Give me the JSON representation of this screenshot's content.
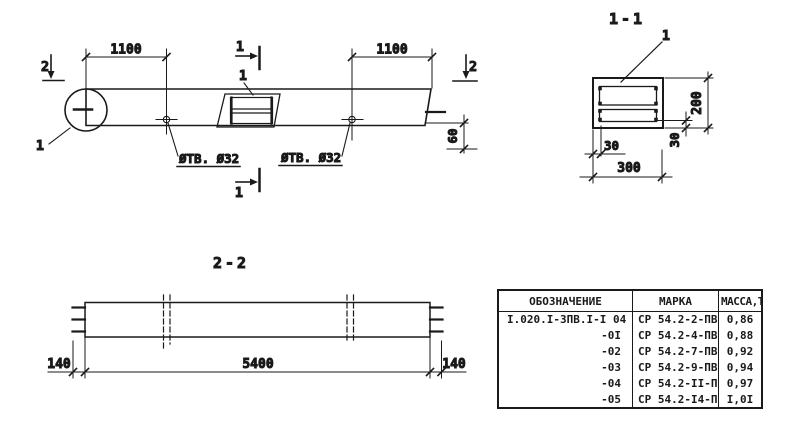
{
  "colors": {
    "ink": "#1a1a1a",
    "paper": "#ffffff"
  },
  "drawing": {
    "elevation": {
      "dim_left": "1100",
      "dim_right": "1100",
      "dim_end_offset": "60",
      "section_marker_top": "1",
      "section_marker_bottom": "1",
      "section_marker_left": "2",
      "section_marker_right": "2",
      "detail_circle_label": "1",
      "insert_leader_label": "1",
      "hole_label_left": "ØТВ. Ø32",
      "hole_label_right": "ØТВ. Ø32"
    },
    "section_1_1": {
      "title": "1-1",
      "rebar_leader_label": "1",
      "dim_height": "200",
      "dim_cover_right": "30",
      "dim_cover_left": "30",
      "dim_width": "300"
    },
    "section_2_2": {
      "title": "2-2",
      "dim_left_overhang": "140",
      "dim_length": "5400",
      "dim_right_overhang": "140"
    }
  },
  "table": {
    "headers": {
      "designation": "ОБОЗНАЧЕНИЕ",
      "mark": "МАРКА",
      "mass": "МАССА,Т"
    },
    "rows": [
      {
        "designation": "I.020.I-3ПВ.I-I 04",
        "mark": "СР 54.2-2-ПВ",
        "mass": "0,86"
      },
      {
        "designation": "-0I",
        "mark": "СР 54.2-4-ПВ",
        "mass": "0,88"
      },
      {
        "designation": "-02",
        "mark": "СР 54.2-7-ПВ",
        "mass": "0,92"
      },
      {
        "designation": "-03",
        "mark": "СР 54.2-9-ПВ",
        "mass": "0,94"
      },
      {
        "designation": "-04",
        "mark": "СР 54.2-II-ПВ",
        "mass": "0,97"
      },
      {
        "designation": "-05",
        "mark": "СР 54.2-I4-ПВ",
        "mass": "I,0I"
      }
    ]
  }
}
